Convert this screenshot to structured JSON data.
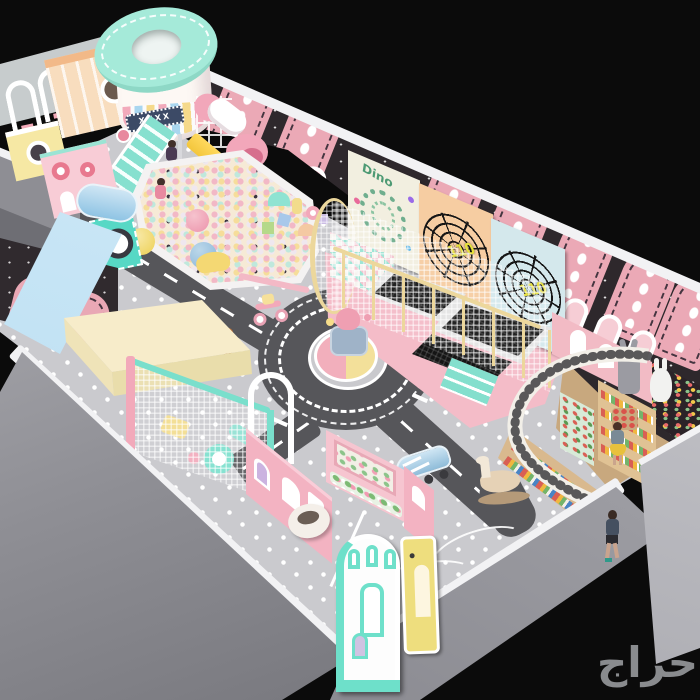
{
  "watermark": {
    "text": "حراج",
    "color": "#94969a"
  },
  "signs": {
    "marquee_text": "XXXX"
  },
  "panels": {
    "dino_label": "Dino",
    "web_score_left": "110",
    "web_score_right": "110"
  },
  "palette": {
    "background": "#0b0b0b",
    "floor_gray": "#cacace",
    "road_gray": "#56565a",
    "wall_dark": "#2e282c",
    "arch_pink": "#eba9b6",
    "stripe_white": "#f2f2f4",
    "mint": "#7adfcc",
    "ball_pit_cream": "#f6ead6",
    "trampoline_base_pink": "#f4bcc8",
    "slide_yellow": "#ffd95e",
    "counter_wood": "#d9b98e",
    "terrazzo_white": "#f2efe8",
    "outer_wall_gray": "#8f8f95"
  }
}
